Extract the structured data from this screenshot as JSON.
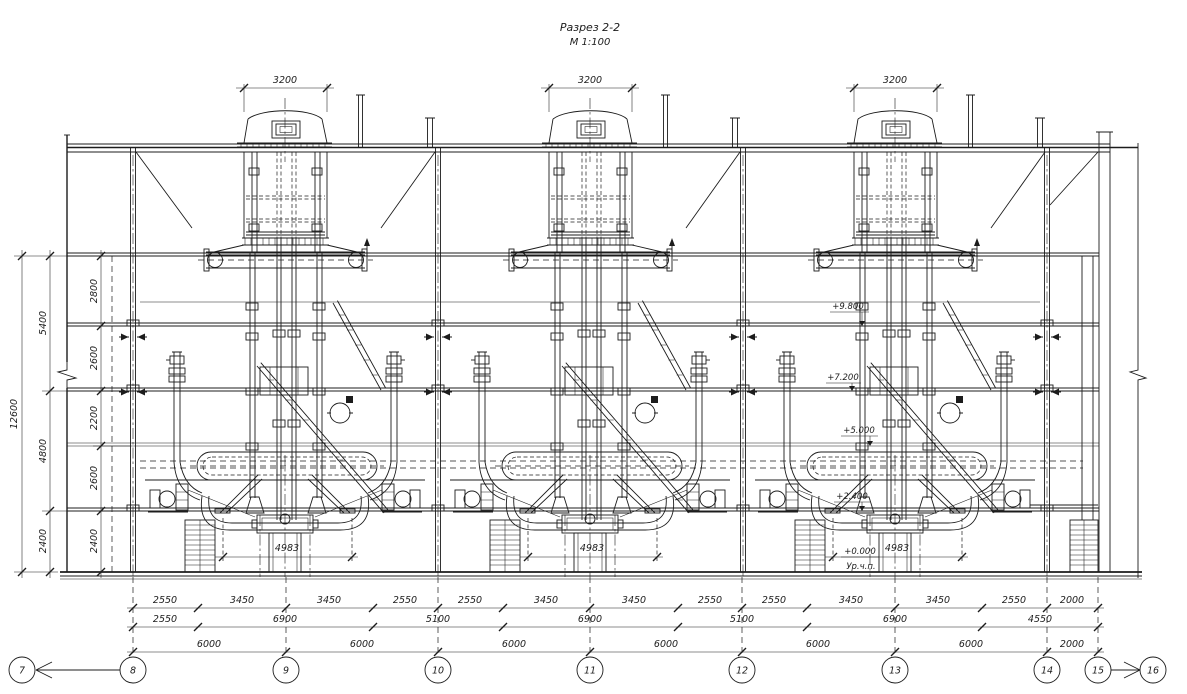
{
  "title": {
    "name": "Разрез 2-2",
    "scale": "М 1:100"
  },
  "machines": [
    {
      "top_width": "3200",
      "base_width": "4983"
    },
    {
      "top_width": "3200",
      "base_width": "4983"
    },
    {
      "top_width": "3200",
      "base_width": "4983"
    }
  ],
  "elevations": {
    "e1": "+9.800",
    "e2": "+7.200",
    "e3": "+5.000",
    "e4": "+2.400",
    "e5": "+0.000",
    "floor_note": "Ур.ч.п."
  },
  "dims_left": {
    "total": "12600",
    "outer": [
      "5400",
      "4800",
      "2400"
    ],
    "inner": [
      "2800",
      "2600",
      "2200",
      "2600",
      "2400"
    ]
  },
  "dims_bottom": {
    "row1": [
      "2550",
      "3450",
      "3450",
      "2550",
      "2550",
      "3450",
      "3450",
      "2550",
      "2550",
      "3450",
      "3450",
      "2550",
      "2000"
    ],
    "row2": [
      "2550",
      "6900",
      "5100",
      "6900",
      "5100",
      "6900",
      "4550"
    ],
    "row3": [
      "6000",
      "6000",
      "6000",
      "6000",
      "6000",
      "6000",
      "2000"
    ]
  },
  "axes": {
    "labels": [
      "7",
      "8",
      "9",
      "10",
      "11",
      "12",
      "13",
      "14",
      "15",
      "16"
    ]
  },
  "colors": {
    "ink": "#1c1c1c",
    "background": "#ffffff"
  }
}
